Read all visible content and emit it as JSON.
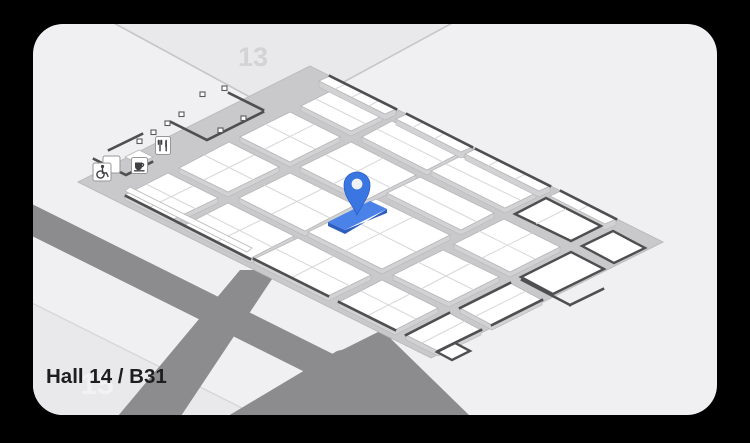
{
  "card": {
    "location_label": "Hall 14 / B31",
    "adjacent_hall_top": "13",
    "adjacent_hall_bottom": "15"
  },
  "marker": {
    "icon": "location-pin-icon",
    "points_to": "highlighted-booth"
  },
  "facility_icons": [
    {
      "name": "wheelchair-icon"
    },
    {
      "name": "coffee-icon"
    },
    {
      "name": "restaurant-icon"
    }
  ],
  "colors": {
    "page_bg": "#000000",
    "card_bg": "#f0f0f2",
    "adjacent_hall_plane": "#e9e9eb",
    "hall_floor": "#c9c9cb",
    "booth_white": "#ffffff",
    "road_gray": "#8c8c8e",
    "wall_dark": "#4f4f52",
    "marker_blue": "#3a76e2",
    "highlight_booth_blue": "#4b82e8",
    "label_text": "#1e1e20",
    "hall_top_text": "#d3d3d5",
    "hall_bottom_text": "#f2f2f4"
  }
}
